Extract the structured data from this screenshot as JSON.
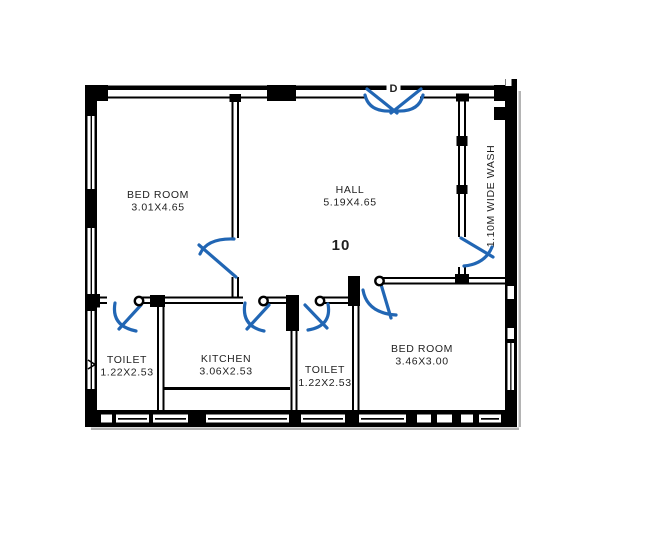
{
  "title": "Apartment floor plan - unit 10",
  "colors": {
    "wall": "#000000",
    "door": "#2166b4",
    "text": "#1f1f1f",
    "shadow": "#b4b4b4"
  },
  "unit_number": "10",
  "door_label": "D",
  "rooms": [
    {
      "id": "bedroom-1",
      "name": "BED ROOM",
      "dims": "3.01X4.65"
    },
    {
      "id": "hall",
      "name": "HALL",
      "dims": "5.19X4.65"
    },
    {
      "id": "toilet-1",
      "name": "TOILET",
      "dims": "1.22X2.53"
    },
    {
      "id": "kitchen",
      "name": "KITCHEN",
      "dims": "3.06X2.53"
    },
    {
      "id": "toilet-2",
      "name": "TOILET",
      "dims": "1.22X2.53"
    },
    {
      "id": "bedroom-2",
      "name": "BED ROOM",
      "dims": "3.46X3.00"
    }
  ],
  "annotations": {
    "wash": "1.10M WIDE WASH"
  }
}
